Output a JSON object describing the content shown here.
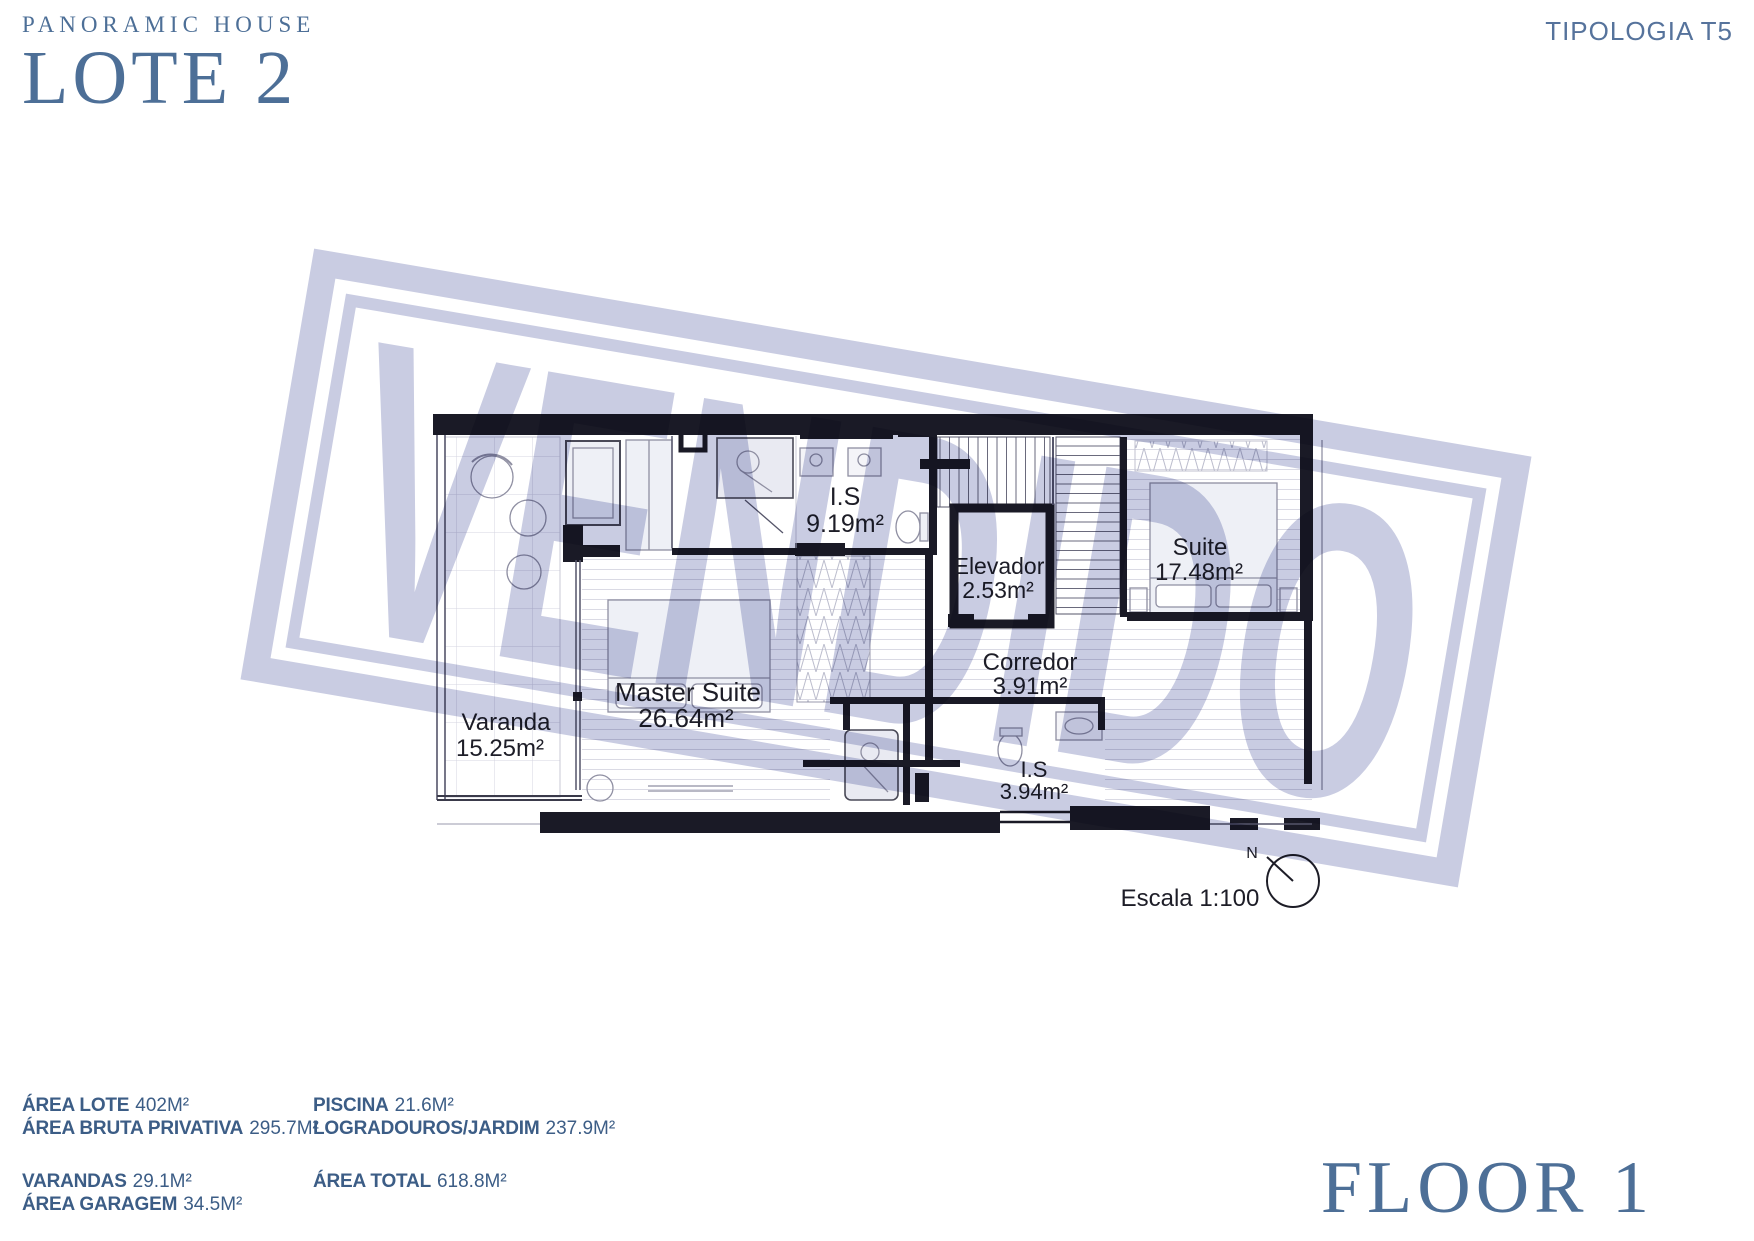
{
  "header": {
    "brand_line1": "PANORAMIC HOUSE",
    "brand_line2": "LOTE 2",
    "typology": "TIPOLOGIA T5"
  },
  "plan": {
    "watermark": "VENDIDO",
    "scale_label": "Escala 1:100",
    "north_label": "N",
    "rooms": [
      {
        "name": "I.S",
        "area": "9.19m²"
      },
      {
        "name": "Elevador",
        "area": "2.53m²"
      },
      {
        "name": "Suite",
        "area": "17.48m²"
      },
      {
        "name": "Corredor",
        "area": "3.91m²"
      },
      {
        "name": "Master Suite",
        "area": "26.64m²"
      },
      {
        "name": "Varanda",
        "area": "15.25m²"
      },
      {
        "name": "I.S",
        "area": "3.94m²"
      }
    ]
  },
  "footer": {
    "areas_col1": [
      {
        "label": "ÁREA LOTE",
        "value": "402M²"
      },
      {
        "label": "ÁREA BRUTA PRIVATIVA",
        "value": "295.7M²"
      },
      {
        "label": "VARANDAS",
        "value": "29.1M²"
      },
      {
        "label": "ÁREA GARAGEM",
        "value": "34.5M²"
      }
    ],
    "areas_col2": [
      {
        "label": "PISCINA",
        "value": "21.6M²"
      },
      {
        "label": "LOGRADOUROS/JARDIM",
        "value": "237.9M²"
      },
      {
        "label": "ÁREA TOTAL",
        "value": "618.8M²"
      }
    ],
    "floor_label": "FLOOR 1"
  },
  "colors": {
    "brand_blue": "#4d6f97",
    "text_blue": "#3c5d86",
    "wall_ink": "#1a1a26",
    "watermark_lavender": "#c9cce2"
  }
}
